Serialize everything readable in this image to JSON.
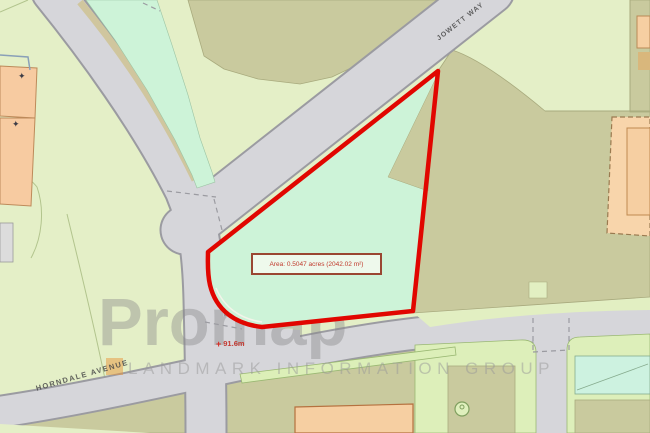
{
  "map": {
    "road_labels": [
      {
        "text": "JOWETT WAY"
      },
      {
        "text": "HORNDALE AVENUE"
      }
    ],
    "parcel": {
      "area_label": "Area: 0.5047 acres (2042.02 m²)",
      "boundary_color": "#e10600",
      "fill_color": "#cdf3d8"
    },
    "spot_height": {
      "marker": "+",
      "text": "91.6m"
    },
    "symbols": {
      "survey_marker": "✦"
    },
    "watermark": {
      "brand": "Promap",
      "registered": "®",
      "subtitle": "LANDMARK INFORMATION GROUP",
      "logo_color": "#e8963c"
    },
    "colors": {
      "field": "#e4efc7",
      "scrub": "#c9ca9e",
      "road": "#d6d6da",
      "road_edge": "#9b9ba1",
      "building": "#f6cfa2",
      "mint_green": "#cdf3d8"
    }
  }
}
